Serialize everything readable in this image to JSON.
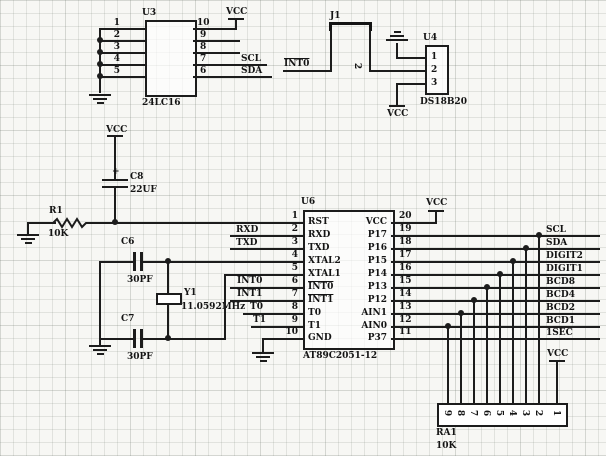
{
  "power": {
    "vcc": "VCC"
  },
  "components": {
    "u3": {
      "ref": "U3",
      "part": "24LC16",
      "left_pins": [
        "1",
        "2",
        "3",
        "4",
        "5"
      ],
      "right_pins": [
        "10",
        "9",
        "8",
        "7",
        "6"
      ]
    },
    "j1": {
      "ref": "J1",
      "pin2_num": "2"
    },
    "u4": {
      "ref": "U4",
      "part": "DS18B20",
      "pins": [
        "1",
        "2",
        "3"
      ]
    },
    "u6": {
      "ref": "U6",
      "part": "AT89C2051-12",
      "left": [
        {
          "num": "1",
          "name": "RST"
        },
        {
          "num": "2",
          "name": "RXD"
        },
        {
          "num": "3",
          "name": "TXD"
        },
        {
          "num": "4",
          "name": "XTAL2"
        },
        {
          "num": "5",
          "name": "XTAL1"
        },
        {
          "num": "6",
          "name": "INT0"
        },
        {
          "num": "7",
          "name": "INT1"
        },
        {
          "num": "8",
          "name": "T0"
        },
        {
          "num": "9",
          "name": "T1"
        },
        {
          "num": "10",
          "name": "GND"
        }
      ],
      "right": [
        {
          "num": "20",
          "name": "VCC"
        },
        {
          "num": "19",
          "name": "P17"
        },
        {
          "num": "18",
          "name": "P16"
        },
        {
          "num": "17",
          "name": "P15"
        },
        {
          "num": "16",
          "name": "P14"
        },
        {
          "num": "15",
          "name": "P13"
        },
        {
          "num": "14",
          "name": "P12"
        },
        {
          "num": "13",
          "name": "AIN1"
        },
        {
          "num": "12",
          "name": "AIN0"
        },
        {
          "num": "11",
          "name": "P37"
        }
      ]
    },
    "r1": {
      "ref": "R1",
      "value": "10K"
    },
    "c6": {
      "ref": "C6",
      "value": "30PF"
    },
    "c7": {
      "ref": "C7",
      "value": "30PF"
    },
    "c8": {
      "ref": "C8",
      "value": "22UF",
      "polarity": "+"
    },
    "y1": {
      "ref": "Y1",
      "value": "11.0592MHz"
    },
    "ra1": {
      "ref": "RA1",
      "value": "10K",
      "pins": [
        "9",
        "8",
        "7",
        "6",
        "5",
        "4",
        "3",
        "2",
        "1"
      ]
    }
  },
  "nets": {
    "rxd": "RXD",
    "txd": "TXD",
    "int0": "INT0",
    "int1": "INT1",
    "t0": "T0",
    "t1": "T1",
    "scl": "SCL",
    "sda": "SDA",
    "digit2": "DIGIT2",
    "digit1": "DIGIT1",
    "bcd8": "BCD8",
    "bcd4": "BCD4",
    "bcd2": "BCD2",
    "bcd1": "BCD1",
    "sec": "1SEC"
  },
  "colors": {
    "wire": "#1c1c1c",
    "grid": "#c4cac4",
    "background": "#f7f7f4"
  }
}
